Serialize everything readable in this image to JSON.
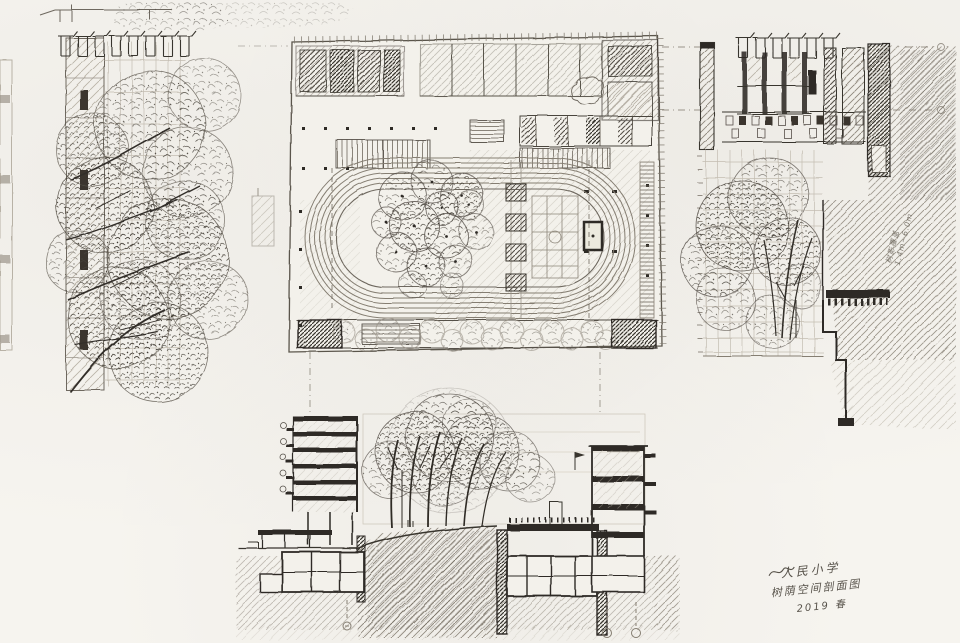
{
  "annotations": {
    "side_note_line1": "树影覆盖",
    "side_note_line2": "1.4m~6.0m",
    "signature_line1": "人民小学",
    "signature_line2": "树荫空间剖面图",
    "signature_line3": "2019 春"
  },
  "palette": {
    "paper": "#f6f4ef",
    "graphite_light": "#b8b2a6",
    "graphite_mid": "#857e72",
    "graphite_dark": "#39352e",
    "poche": "#2e2b26"
  }
}
